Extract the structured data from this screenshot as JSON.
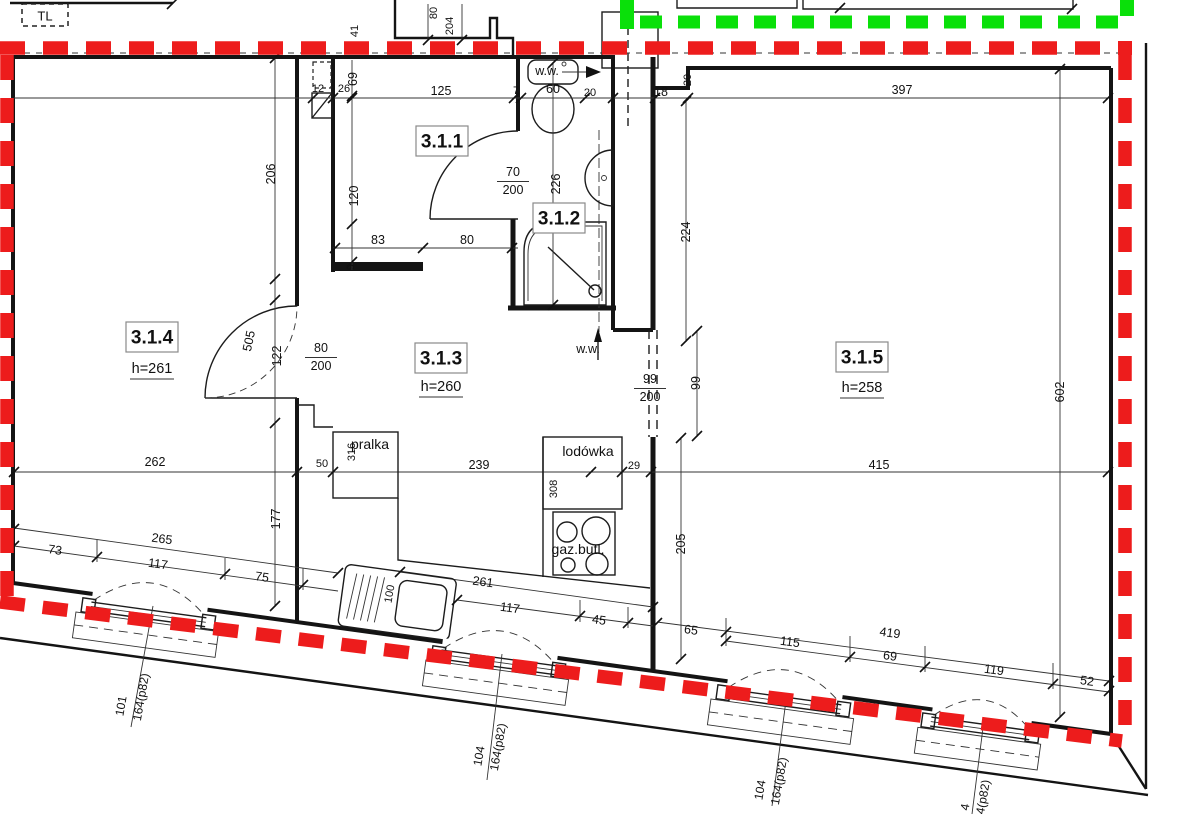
{
  "colors": {
    "boundary_red": "#ed1c1c",
    "boundary_green": "#0ae00a",
    "line": "#141414"
  },
  "plan": {
    "rooms": [
      {
        "id": "3.1.1",
        "pos": [
          442,
          141
        ]
      },
      {
        "id": "3.1.2",
        "pos": [
          559,
          218
        ]
      },
      {
        "id": "3.1.3",
        "pos": [
          441,
          358
        ],
        "height": "h=260",
        "height_pos": [
          441,
          387
        ]
      },
      {
        "id": "3.1.4",
        "pos": [
          152,
          337
        ],
        "height": "h=261",
        "height_pos": [
          152,
          369
        ]
      },
      {
        "id": "3.1.5",
        "pos": [
          862,
          357
        ],
        "height": "h=258",
        "height_pos": [
          862,
          388
        ]
      }
    ],
    "appliances": [
      {
        "name": "washer-label",
        "text": "pralka",
        "pos": [
          370,
          444
        ]
      },
      {
        "name": "fridge-label",
        "text": "lodówka",
        "pos": [
          588,
          451
        ]
      },
      {
        "name": "gas-stove-label",
        "text": "gaz.butl.",
        "pos": [
          578,
          549
        ]
      }
    ],
    "annotations": [
      {
        "name": "tl-label",
        "text": "TL",
        "pos": [
          45,
          16
        ],
        "style": "tl"
      },
      {
        "name": "vent-label-1",
        "text": "w.w.",
        "pos": [
          547,
          71
        ],
        "style": "ww"
      },
      {
        "name": "vent-label-2",
        "text": "w.w.",
        "pos": [
          588,
          349
        ],
        "style": "ww"
      }
    ],
    "door_sizes": [
      {
        "name": "door-314",
        "num": "80",
        "den": "200",
        "pos": [
          321,
          348
        ]
      },
      {
        "name": "door-311",
        "num": "70",
        "den": "200",
        "pos": [
          513,
          172
        ]
      },
      {
        "name": "opening-315",
        "num": "99",
        "den": "200",
        "pos": [
          650,
          379
        ]
      }
    ],
    "windows": [
      {
        "name": "window-1",
        "ref": "101",
        "size": "164(p82)",
        "ref_pos": [
          121,
          706
        ],
        "size_pos": [
          141,
          697
        ],
        "rot": -80
      },
      {
        "name": "window-2",
        "ref": "104",
        "size": "164(p82)",
        "ref_pos": [
          479,
          756
        ],
        "size_pos": [
          498,
          747
        ],
        "rot": -80
      },
      {
        "name": "window-3",
        "ref": "104",
        "size": "164(p82)",
        "ref_pos": [
          760,
          790
        ],
        "size_pos": [
          779,
          781
        ],
        "rot": -80
      },
      {
        "name": "window-4",
        "ref": "4",
        "size": "4(p82)",
        "ref_pos": [
          965,
          807
        ],
        "size_pos": [
          983,
          797
        ],
        "rot": -80
      }
    ],
    "dimensions": [
      {
        "n": "dim-80-top",
        "t": "80",
        "x": 434,
        "y": 13,
        "r": -90,
        "s": "sm"
      },
      {
        "n": "dim-204-top",
        "t": "204",
        "x": 450,
        "y": 26,
        "r": -90,
        "s": "sm"
      },
      {
        "n": "dim-41",
        "t": "41",
        "x": 355,
        "y": 31,
        "r": -90,
        "s": "sm"
      },
      {
        "n": "dim-12",
        "t": "12",
        "x": 318,
        "y": 89,
        "r": 0,
        "s": "sm"
      },
      {
        "n": "dim-26",
        "t": "26",
        "x": 344,
        "y": 89,
        "r": 0,
        "s": "sm"
      },
      {
        "n": "dim-125",
        "t": "125",
        "x": 441,
        "y": 91,
        "r": 0,
        "s": "dim"
      },
      {
        "n": "dim-7",
        "t": "7",
        "x": 516,
        "y": 91,
        "r": 0,
        "s": "sm"
      },
      {
        "n": "dim-60",
        "t": "60",
        "x": 553,
        "y": 89,
        "r": 0,
        "s": "dim"
      },
      {
        "n": "dim-20-entry",
        "t": "20",
        "x": 590,
        "y": 93,
        "r": 0,
        "s": "sm"
      },
      {
        "n": "dim-18",
        "t": "18",
        "x": 661,
        "y": 92,
        "r": 0,
        "s": "dim"
      },
      {
        "n": "dim-20-315",
        "t": "20",
        "x": 688,
        "y": 80,
        "r": -90,
        "s": "sm"
      },
      {
        "n": "dim-397",
        "t": "397",
        "x": 902,
        "y": 90,
        "r": 0,
        "s": "dim"
      },
      {
        "n": "dim-69",
        "t": "69",
        "x": 353,
        "y": 79,
        "r": -90,
        "s": "dim"
      },
      {
        "n": "dim-206",
        "t": "206",
        "x": 271,
        "y": 174,
        "r": -90,
        "s": "dim"
      },
      {
        "n": "dim-120",
        "t": "120",
        "x": 354,
        "y": 196,
        "r": -90,
        "s": "dim"
      },
      {
        "n": "dim-9",
        "t": "9",
        "x": 351,
        "y": 267,
        "r": -90,
        "s": "sm"
      },
      {
        "n": "dim-83",
        "t": "83",
        "x": 378,
        "y": 240,
        "r": 0,
        "s": "dim"
      },
      {
        "n": "dim-80-kit",
        "t": "80",
        "x": 467,
        "y": 240,
        "r": 0,
        "s": "dim"
      },
      {
        "n": "dim-505",
        "t": "505",
        "x": 249,
        "y": 341,
        "r": -78,
        "s": "dim"
      },
      {
        "n": "dim-122",
        "t": "122",
        "x": 277,
        "y": 356,
        "r": -90,
        "s": "dim"
      },
      {
        "n": "dim-226",
        "t": "226",
        "x": 556,
        "y": 184,
        "r": -90,
        "s": "dim"
      },
      {
        "n": "dim-224",
        "t": "224",
        "x": 686,
        "y": 232,
        "r": -90,
        "s": "dim"
      },
      {
        "n": "dim-99v",
        "t": "99",
        "x": 696,
        "y": 383,
        "r": -90,
        "s": "dim"
      },
      {
        "n": "dim-602",
        "t": "602",
        "x": 1060,
        "y": 392,
        "r": -90,
        "s": "dim"
      },
      {
        "n": "dim-316",
        "t": "316",
        "x": 352,
        "y": 452,
        "r": -90,
        "s": "sm"
      },
      {
        "n": "dim-308",
        "t": "308",
        "x": 554,
        "y": 489,
        "r": -90,
        "s": "sm"
      },
      {
        "n": "dim-29",
        "t": "29",
        "x": 634,
        "y": 466,
        "r": 0,
        "s": "sm"
      },
      {
        "n": "dim-239",
        "t": "239",
        "x": 479,
        "y": 465,
        "r": 0,
        "s": "dim"
      },
      {
        "n": "dim-262",
        "t": "262",
        "x": 155,
        "y": 462,
        "r": 0,
        "s": "dim"
      },
      {
        "n": "dim-50",
        "t": "50",
        "x": 322,
        "y": 464,
        "r": 0,
        "s": "sm"
      },
      {
        "n": "dim-177",
        "t": "177",
        "x": 276,
        "y": 519,
        "r": -90,
        "s": "dim"
      },
      {
        "n": "dim-265",
        "t": "265",
        "x": 162,
        "y": 539,
        "r": 7.8,
        "s": "dim"
      },
      {
        "n": "dim-73",
        "t": "73",
        "x": 55,
        "y": 550,
        "r": 7.8,
        "s": "dim"
      },
      {
        "n": "dim-117a",
        "t": "117",
        "x": 158,
        "y": 564,
        "r": 7.8,
        "s": "dim"
      },
      {
        "n": "dim-75",
        "t": "75",
        "x": 262,
        "y": 577,
        "r": 7.8,
        "s": "dim"
      },
      {
        "n": "dim-100",
        "t": "100",
        "x": 390,
        "y": 594,
        "r": -80,
        "s": "sm"
      },
      {
        "n": "dim-261",
        "t": "261",
        "x": 483,
        "y": 582,
        "r": 7.8,
        "s": "dim"
      },
      {
        "n": "dim-117b",
        "t": "117",
        "x": 510,
        "y": 608,
        "r": 7.8,
        "s": "dim"
      },
      {
        "n": "dim-45",
        "t": "45",
        "x": 599,
        "y": 620,
        "r": 7.8,
        "s": "dim"
      },
      {
        "n": "dim-205",
        "t": "205",
        "x": 681,
        "y": 544,
        "r": -90,
        "s": "dim"
      },
      {
        "n": "dim-415",
        "t": "415",
        "x": 879,
        "y": 465,
        "r": 0,
        "s": "dim"
      },
      {
        "n": "dim-65",
        "t": "65",
        "x": 691,
        "y": 630,
        "r": 7.8,
        "s": "dim"
      },
      {
        "n": "dim-419",
        "t": "419",
        "x": 890,
        "y": 633,
        "r": 7.8,
        "s": "dim"
      },
      {
        "n": "dim-115",
        "t": "115",
        "x": 790,
        "y": 642,
        "r": 7.8,
        "s": "dim"
      },
      {
        "n": "dim-69b",
        "t": "69",
        "x": 890,
        "y": 656,
        "r": 7.8,
        "s": "dim"
      },
      {
        "n": "dim-119",
        "t": "119",
        "x": 994,
        "y": 670,
        "r": 7.8,
        "s": "dim"
      },
      {
        "n": "dim-52",
        "t": "52",
        "x": 1087,
        "y": 681,
        "r": 7.8,
        "s": "dim"
      }
    ]
  }
}
